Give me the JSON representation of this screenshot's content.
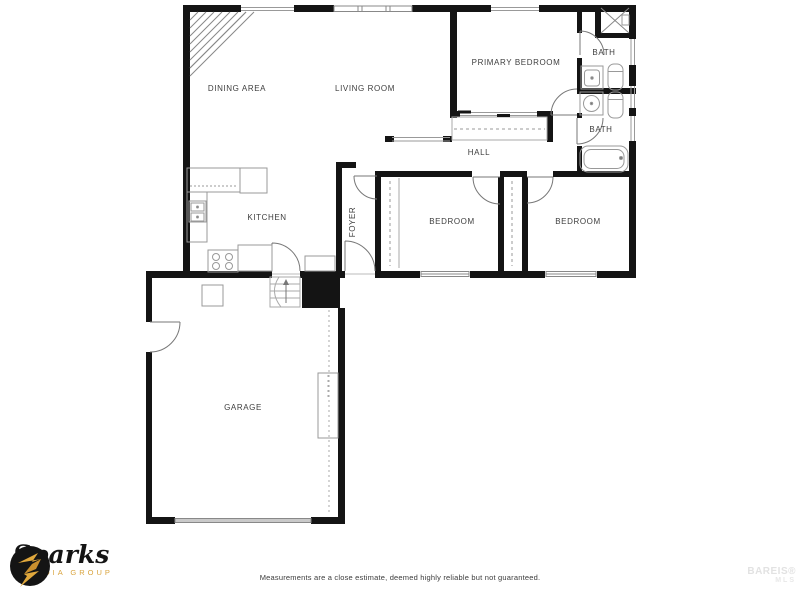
{
  "plan": {
    "rooms": {
      "dining": "DINING AREA",
      "living": "LIVING ROOM",
      "primary_bedroom": "PRIMARY BEDROOM",
      "bath_upper": "BATH",
      "bath_lower": "BATH",
      "hall": "HALL",
      "kitchen": "KITCHEN",
      "foyer": "FOYER",
      "bedroom_left": "BEDROOM",
      "bedroom_right": "BEDROOM",
      "garage": "GARAGE"
    },
    "colors": {
      "wall": "#141414",
      "fixture_line": "#999999",
      "label": "#3e3e3e"
    }
  },
  "branding": {
    "logo_script": "Sparks",
    "logo_subtitle": "MEDIA GROUP",
    "gold": "#d9a43e"
  },
  "footer": {
    "disclaimer": "Measurements are a close estimate, deemed highly reliable but not guaranteed."
  },
  "watermark": {
    "line1": "BAREIS®",
    "line2": "MLS"
  }
}
